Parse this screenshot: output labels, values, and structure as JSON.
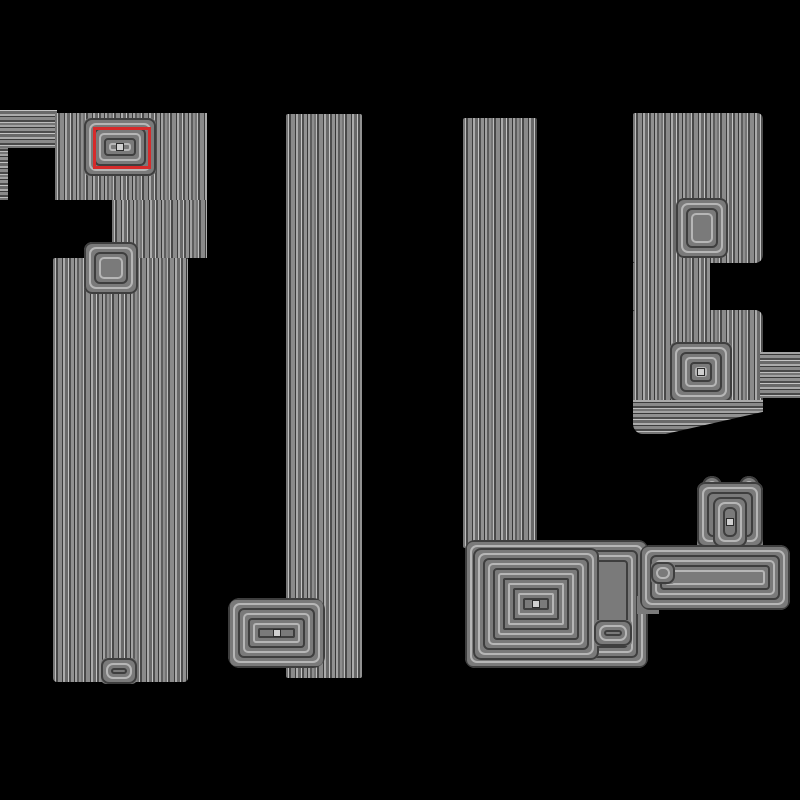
{
  "canvas": {
    "width": 800,
    "height": 800,
    "background": "#000000"
  },
  "palette": {
    "background": "#000000",
    "contour_mid": "#7a7a7a",
    "contour_dark": "#3e3e3e",
    "contour_light": "#b6b6b6",
    "annotation_red": "#d62b2b"
  },
  "annotation": {
    "name": "selection-box",
    "x": 93,
    "y": 127,
    "w": 58,
    "h": 42,
    "border_px": 3
  },
  "scene": {
    "shapes": [
      {
        "name": "left-arm-contours",
        "type": "hstripes",
        "x": 0,
        "y": 110,
        "w": 57,
        "h": 38
      },
      {
        "name": "left-edge-sliver",
        "type": "hstripes",
        "x": 0,
        "y": 148,
        "w": 8,
        "h": 52
      },
      {
        "name": "column1-upper",
        "type": "vstripes",
        "x": 55,
        "y": 113,
        "w": 152,
        "h": 87
      },
      {
        "name": "column1-notch-band",
        "type": "vstripes",
        "x": 112,
        "y": 200,
        "w": 95,
        "h": 58
      },
      {
        "name": "column1-main",
        "type": "vstripes",
        "x": 53,
        "y": 258,
        "w": 135,
        "h": 424,
        "br": "2px 2px 4px 4px"
      },
      {
        "name": "column1-notch-contours",
        "type": "rings",
        "x": 84,
        "y": 242,
        "w": 54,
        "h": 52,
        "rings": 4,
        "br": "8px"
      },
      {
        "name": "column1-target-contours",
        "type": "rings",
        "x": 84,
        "y": 118,
        "w": 72,
        "h": 58,
        "rings": 6,
        "br": "6px",
        "center": true
      },
      {
        "name": "column1-bottom-node",
        "type": "rings",
        "x": 101,
        "y": 658,
        "w": 36,
        "h": 26,
        "rings": 3,
        "br": "5px"
      },
      {
        "name": "column2",
        "type": "vstripes",
        "x": 286,
        "y": 114,
        "w": 76,
        "h": 564,
        "br": "2px"
      },
      {
        "name": "column2-foot-contours",
        "type": "rings",
        "x": 228,
        "y": 598,
        "w": 97,
        "h": 70,
        "rings": 8,
        "br": "12px",
        "center": true
      },
      {
        "name": "column3",
        "type": "vstripes",
        "x": 463,
        "y": 118,
        "w": 74,
        "h": 430,
        "br": "2px"
      },
      {
        "name": "bottom-region-frame",
        "type": "rings",
        "x": 465,
        "y": 540,
        "w": 183,
        "h": 128,
        "rings": 5,
        "br": "10px"
      },
      {
        "name": "bottom-region-square",
        "type": "rings",
        "x": 473,
        "y": 548,
        "w": 126,
        "h": 112,
        "rings": 11,
        "br": "8px",
        "center": true
      },
      {
        "name": "bottom-region-smallbox",
        "type": "rings",
        "x": 594,
        "y": 620,
        "w": 38,
        "h": 26,
        "rings": 3,
        "br": "4px"
      },
      {
        "name": "bridge-fill",
        "type": "fill",
        "x": 637,
        "y": 596,
        "w": 22,
        "h": 18
      },
      {
        "name": "column4-top",
        "type": "vstripes",
        "x": 633,
        "y": 113,
        "w": 130,
        "h": 150,
        "br": "2px 6px 8px 2px"
      },
      {
        "name": "column4-neck",
        "type": "vstripes",
        "x": 633,
        "y": 263,
        "w": 77,
        "h": 47
      },
      {
        "name": "column4-lower",
        "type": "vstripes",
        "x": 633,
        "y": 310,
        "w": 130,
        "h": 93,
        "br": "2px 8px 2px 2px"
      },
      {
        "name": "column4-vee-contours",
        "type": "rings",
        "x": 676,
        "y": 198,
        "w": 52,
        "h": 60,
        "rings": 4,
        "br": "8px"
      },
      {
        "name": "column4-node-contours",
        "type": "rings",
        "x": 670,
        "y": 342,
        "w": 62,
        "h": 60,
        "rings": 6,
        "br": "6px",
        "center": true
      },
      {
        "name": "column4-right-protrusion",
        "type": "hstripes",
        "x": 760,
        "y": 352,
        "w": 40,
        "h": 46
      },
      {
        "name": "column4-taper",
        "type": "hstripes",
        "x": 633,
        "y": 400,
        "w": 130,
        "h": 34,
        "br": "0 0 6px 10px",
        "clip": "polygon(0 0, 100% 0, 100% 35%, 25% 100%, 0 100%)"
      },
      {
        "name": "tee-bump-left",
        "type": "rings",
        "x": 702,
        "y": 476,
        "w": 20,
        "h": 20,
        "rings": 2,
        "br": "50%"
      },
      {
        "name": "tee-bump-right",
        "type": "rings",
        "x": 739,
        "y": 476,
        "w": 20,
        "h": 20,
        "rings": 2,
        "br": "50%"
      },
      {
        "name": "tee-stem-frame",
        "type": "rings",
        "x": 697,
        "y": 482,
        "w": 66,
        "h": 65,
        "rings": 3,
        "br": "8px 8px 0 0"
      },
      {
        "name": "tee-stem-core",
        "type": "rings",
        "x": 713,
        "y": 497,
        "w": 34,
        "h": 50,
        "rings": 4,
        "br": "4px",
        "center": true
      },
      {
        "name": "tee-bar-frame",
        "type": "rings",
        "x": 640,
        "y": 545,
        "w": 150,
        "h": 65,
        "rings": 6,
        "br": "10px"
      },
      {
        "name": "tee-bar-node",
        "type": "rings",
        "x": 651,
        "y": 562,
        "w": 24,
        "h": 22,
        "rings": 2,
        "br": "4px"
      }
    ]
  }
}
